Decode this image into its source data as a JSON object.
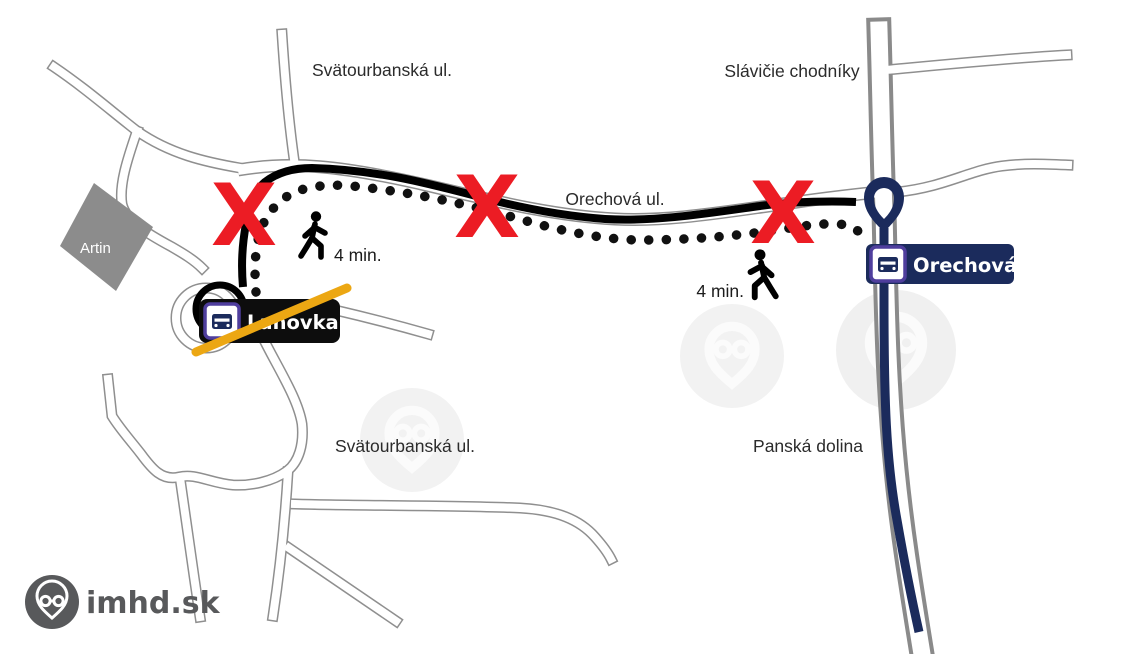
{
  "map": {
    "streets": {
      "svatourbanska_top": "Svätourbanská ul.",
      "slavicie_chodniky": "Slávičie chodníky",
      "orechova_ul": "Orechová ul.",
      "svatourbanska_bottom": "Svätourbanská ul.",
      "panska_dolina": "Panská dolina"
    },
    "building": {
      "artin": "Artin"
    },
    "stops": {
      "lanovka": {
        "name": "Lanovka",
        "status": "closed (crossed out)"
      },
      "orechova": {
        "name": "Orechová",
        "status": "active replacement stop"
      }
    },
    "walking": {
      "west_label": "4 min.",
      "east_label": "4 min."
    },
    "markers": {
      "closed_x_glyph": "X"
    },
    "legend_semantics": {
      "black_line": "closed bus route",
      "dotted_line": "walking path",
      "navy_line": "diverted route / stop position"
    },
    "icons": [
      "bus-stop-icon",
      "pedestrian-icon",
      "stop-pin-icon",
      "imhd-logo-icon",
      "watermark-pin-icon"
    ],
    "colors": {
      "closure_x": "#ec1c24",
      "closed_route": "#000000",
      "diversion_route": "#1b2b5c",
      "stop_flag_navy": "#1b2b5c",
      "stop_flag_black": "#0d0d0d",
      "strike_gold": "#eca713",
      "bus_icon_border": "#4f3e9d",
      "road_casing": "#8f8f8f",
      "building_gray": "#8c8c8c",
      "brand_gray": "#58595b"
    }
  },
  "branding": {
    "logo_text": "imhd.sk"
  }
}
